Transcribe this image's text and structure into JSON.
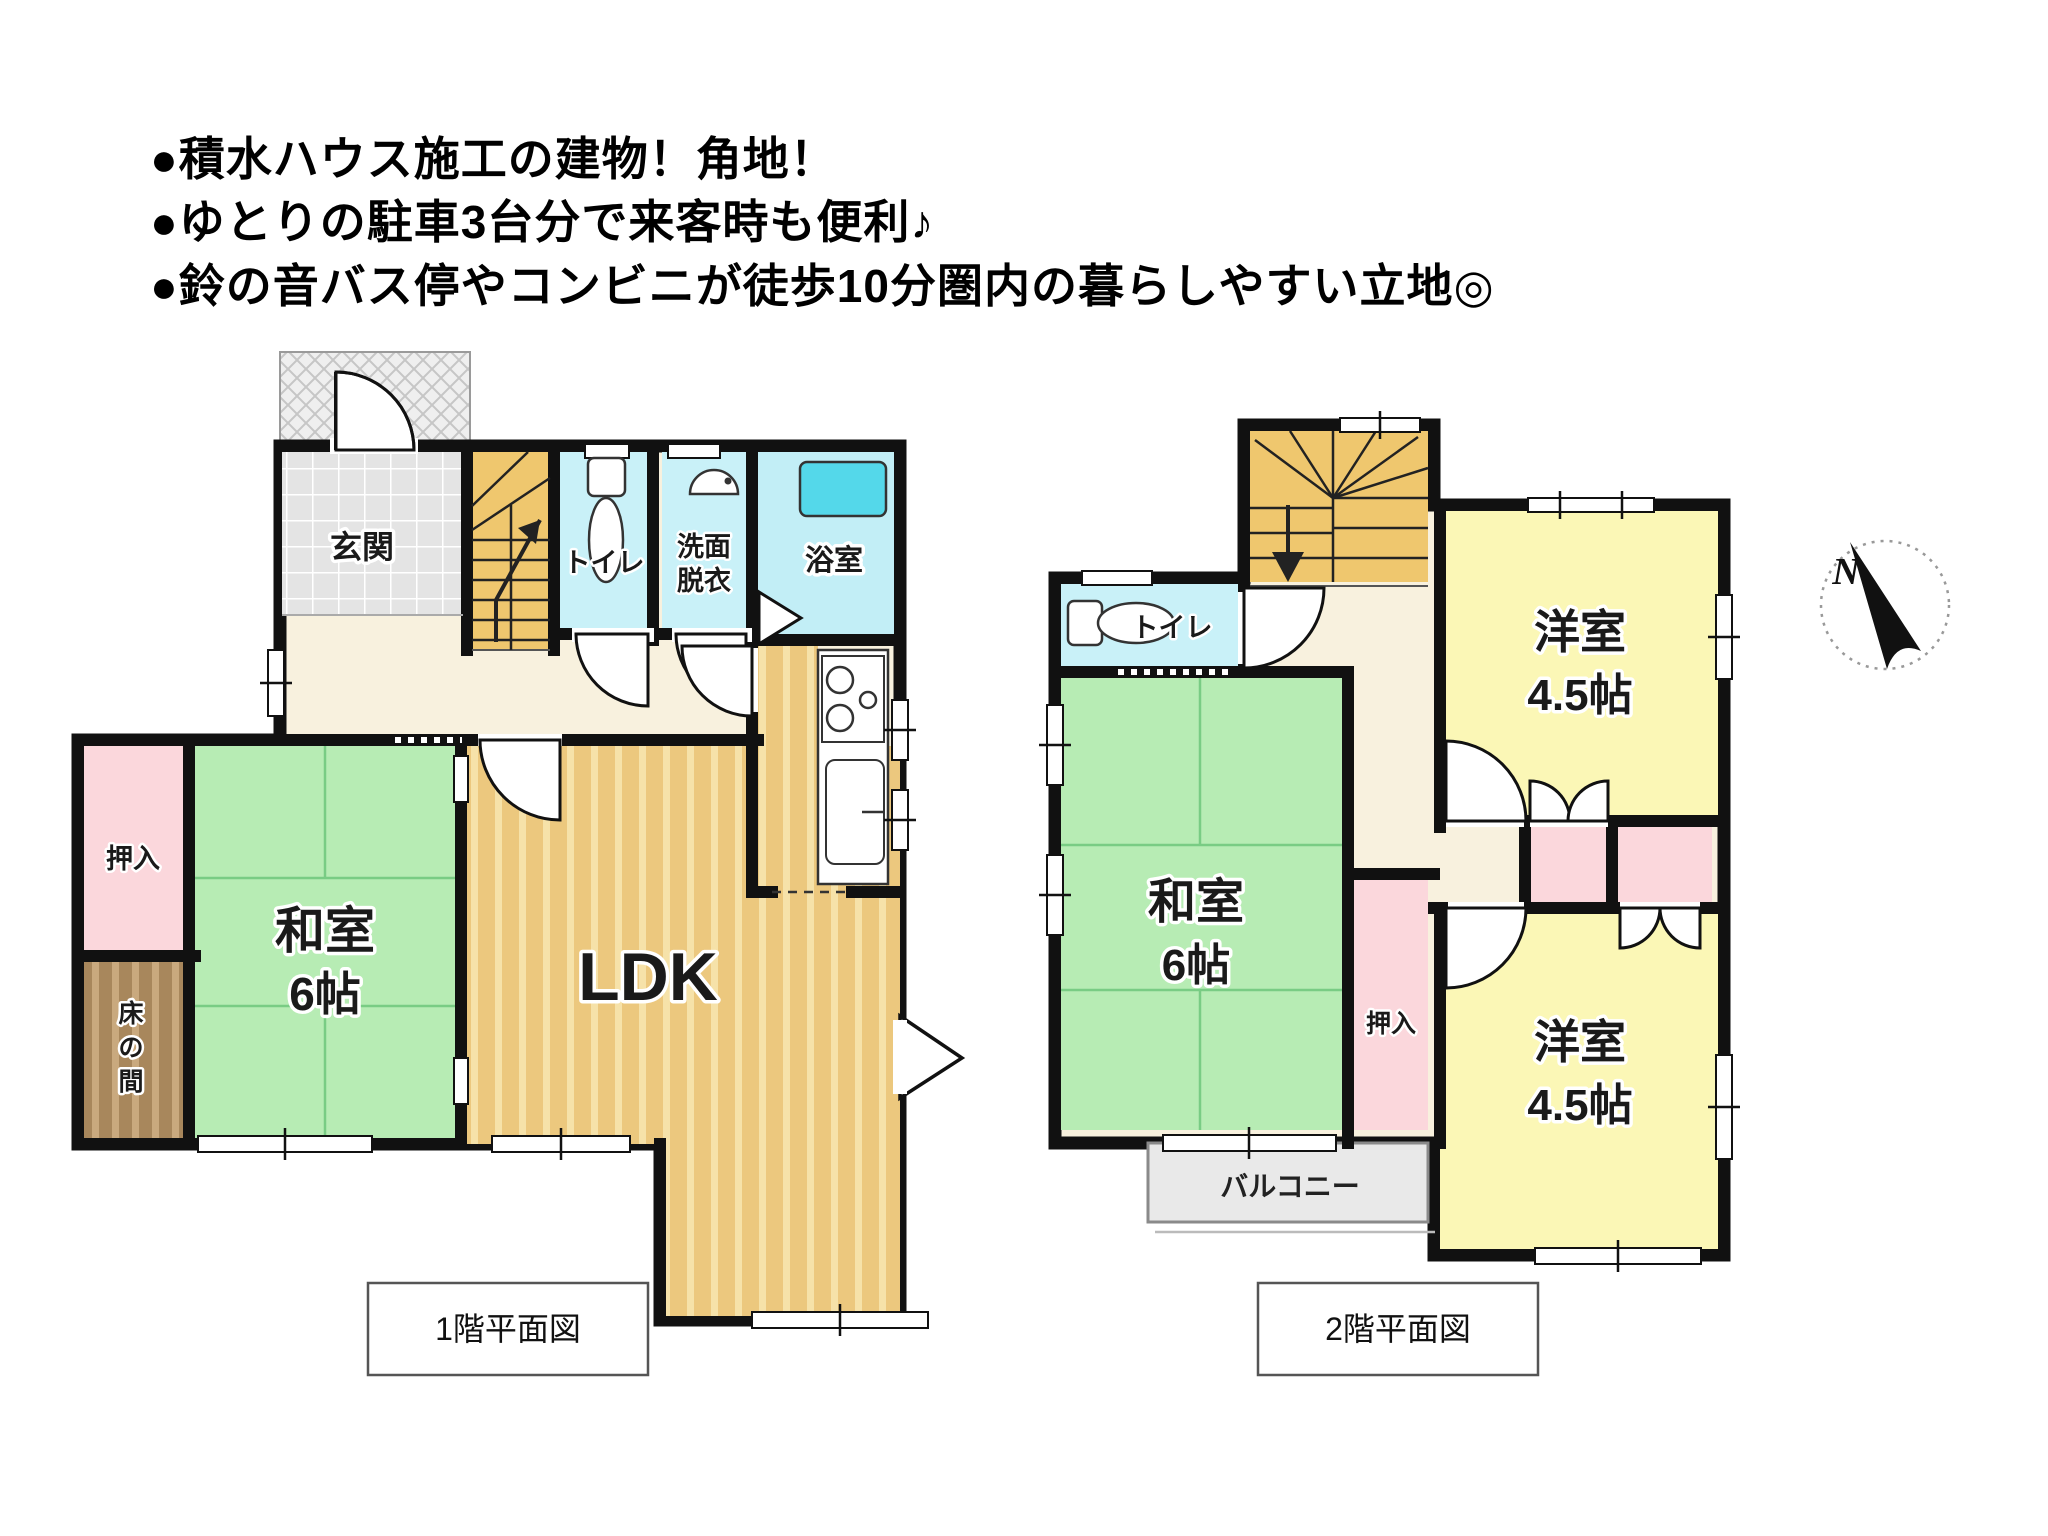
{
  "header": {
    "lines": [
      "●積水ハウス施工の建物！角地！",
      "●ゆとりの駐車3台分で来客時も便利♪",
      "●鈴の音バス停やコンビニが徒歩10分圏内の暮らしやすい立地◎"
    ]
  },
  "floor1": {
    "caption": "1階平面図",
    "labels": {
      "genkan": "玄関",
      "toilet": "トイレ",
      "wash1": "洗面",
      "wash2": "脱衣",
      "bath": "浴室",
      "washitsu": "和室",
      "washitsu_size": "6帖",
      "ldk": "LDK",
      "oshiire": "押入",
      "tokonoma": [
        "床",
        "の",
        "間"
      ]
    }
  },
  "floor2": {
    "caption": "2階平面図",
    "labels": {
      "toilet": "トイレ",
      "washitsu": "和室",
      "washitsu_size": "6帖",
      "yoshitsu_a": "洋室",
      "yoshitsu_a_size": "4.5帖",
      "yoshitsu_b": "洋室",
      "yoshitsu_b_size": "4.5帖",
      "oshiire": "押入",
      "balcony": "バルコニー"
    }
  },
  "compass": {
    "north": "N"
  },
  "colors": {
    "wall": "#111111",
    "hall_floor": "#F8F1DE",
    "tatami_green": "#B7ECB4",
    "tatami_line": "#79CC84",
    "wood_floor": "#ECC87E",
    "wood_stripe": "#F6E2A9",
    "water_cyan": "#C9F1F8",
    "bath_cyan": "#C2EEF6",
    "tub_cyan": "#54D8EA",
    "closet_pink": "#FBD7DC",
    "western_yellow": "#FBF7B6",
    "stairs_tan": "#EFC76E",
    "genkan_tile": "#E4E4E4",
    "tokonoma_brown": "#A8875C",
    "tokonoma_stripe": "#C9A97E",
    "balcony_gray": "#E9E9E9",
    "porch_gray": "#EFEFEF"
  }
}
